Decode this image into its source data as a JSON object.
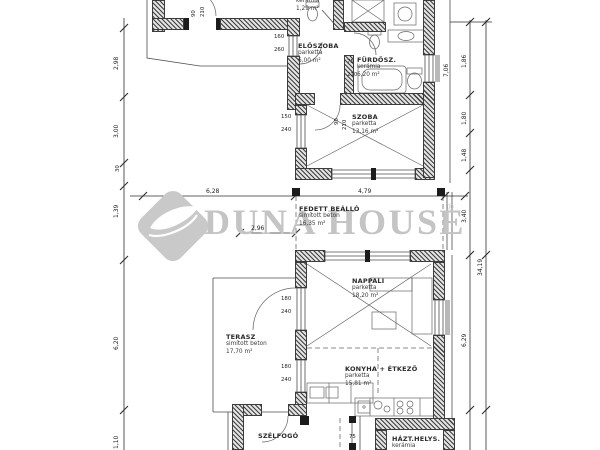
{
  "watermark": {
    "brand": "DUNA HOUSE",
    "registered": "®"
  },
  "rooms": [
    {
      "name": "ELŐSZOBA",
      "material": "parketta",
      "area": "6,00 m²"
    },
    {
      "name": "FÜRDŐSZ.",
      "material": "kerámia",
      "area": "6,20 m²"
    },
    {
      "name": "WC",
      "material": "kerámia",
      "area": "1,29 m²"
    },
    {
      "name": "SZOBA",
      "material": "parketta",
      "area": "13,16 m²"
    },
    {
      "name": "FEDETT BEÁLLÓ",
      "material": "simított beton",
      "area": "16,35 m²"
    },
    {
      "name": "NAPPALI",
      "material": "parketta",
      "area": "18,20 m²"
    },
    {
      "name": "TERASZ",
      "material": "simított beton",
      "area": "17,70 m²"
    },
    {
      "name": "KONYHA + ÉTKEZŐ",
      "material": "parketta",
      "area": "15,81 m²"
    },
    {
      "name": "SZÉLFOGÓ",
      "material": "",
      "area": ""
    },
    {
      "name": "HÁZT.HELYS.",
      "material": "kerámia",
      "area": ""
    }
  ],
  "dimensions": {
    "left": [
      "2,98",
      "3,00",
      "30",
      "1,39",
      "6,20",
      "1,10"
    ],
    "right_inner": [
      "1,86",
      "1,80",
      "1,48",
      "3,40",
      "6,29"
    ],
    "right_outer": [
      "7,06",
      "34,19"
    ],
    "horizontal": [
      "6,28",
      "4,79",
      "2,96"
    ],
    "openings": [
      "160",
      "260",
      "75",
      "210",
      "150",
      "240",
      "90",
      "210",
      "180",
      "240",
      "180",
      "240",
      "75",
      "90",
      "210"
    ]
  }
}
